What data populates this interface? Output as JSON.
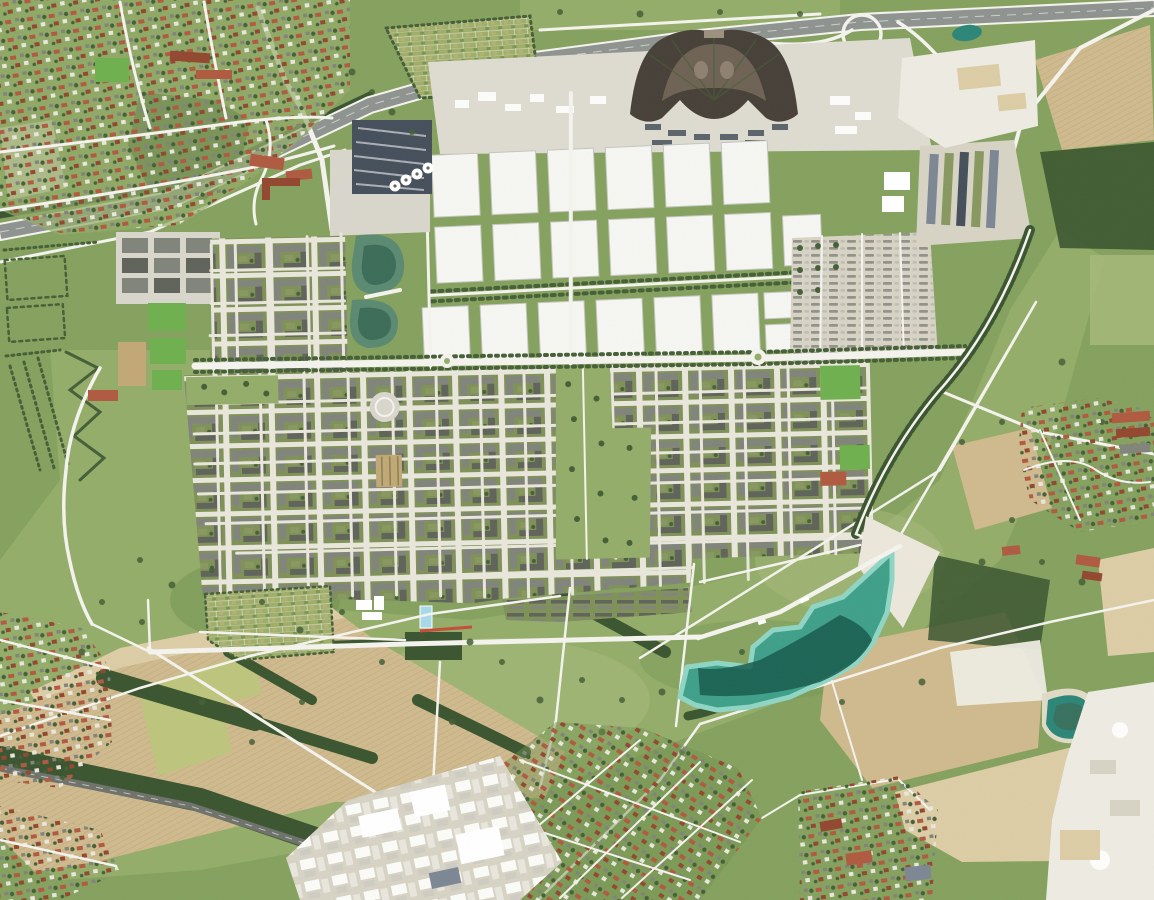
{
  "scene": {
    "type": "aerial-orthophoto",
    "description": "Aerial orthophoto of a trade-fair city district: rows of white exhibition halls, a dark fan-shaped former airport terminal by a motorway, dense residential quarters with green courtyards, a large landscape park crossed by diagonal white paths, a turquoise bathing lake with a sand beach, surrounded by farm fields, old villages with red roofs, a railway line and gravel quarries.",
    "landmarks": [
      "motorway",
      "motorway-interchange",
      "fan-shaped-terminal-building",
      "exhibition-halls",
      "congress-center",
      "trade-fair-parking",
      "old-village-north-west",
      "allotment-gardens",
      "office-blocks",
      "formal-gardens",
      "sports-fields",
      "residential-quarters",
      "central-green-axis",
      "tree-lined-boulevard",
      "community-gardens",
      "landscape-park",
      "bathing-lake",
      "sand-beach",
      "farm-fields",
      "gravel-quarry-north",
      "gravel-quarry-south-east",
      "pond-north-east",
      "pond-south-east",
      "suburb-south",
      "village-south-east",
      "village-east",
      "railway-line",
      "industrial-area-north-east",
      "commercial-area-south-west"
    ]
  },
  "palette": {
    "grass": "#85a15e",
    "meadow": "#94ad69",
    "meadowLight": "#a6ba7b",
    "meadowDark": "#70924f",
    "woods": "#3b5530",
    "tree": "#455f37",
    "field": "#cfba8d",
    "fieldLight": "#dccda6",
    "fieldPale": "#e0dbc6",
    "fieldYellow": "#bdc47d",
    "highway": "#8f9390",
    "road": "#f4f3ed",
    "streetLight": "#e9e7db",
    "rail": "#6e726a",
    "serviceGray": "#dedbd1",
    "gravel": "#d7d3c5",
    "plaza": "#d9d6cc",
    "hallWhite": "#f6f6f3",
    "hallEdge": "#c6c6c0",
    "steel": "#454f5b",
    "steelLight": "#7d8794",
    "fanDark": "#474038",
    "fanMid": "#6e6254",
    "fanLight": "#9c8f7d",
    "urbanCourt": "#7f9158",
    "bldgGray": "#81847a",
    "bldgDark": "#5f6359",
    "bldgGreen": "#87985f",
    "redRoof": "#b05a41",
    "redRoofDark": "#93472f",
    "white": "#ffffff",
    "lakeEdge": "#8fd5c4",
    "lakeMid": "#3fa089",
    "lakeDeep": "#185a4e",
    "beach": "#ebe7da",
    "pondGreen": "#5a8971",
    "pondDeep": "#3c6c59",
    "pondTeal": "#2b8678",
    "poolBlue": "#a8d9ea",
    "trackRed": "#c24e38",
    "pitch": "#6fb04f",
    "pitchTan": "#c2a875",
    "quarry": "#edebe2",
    "allotBg": "#9fae6b"
  }
}
